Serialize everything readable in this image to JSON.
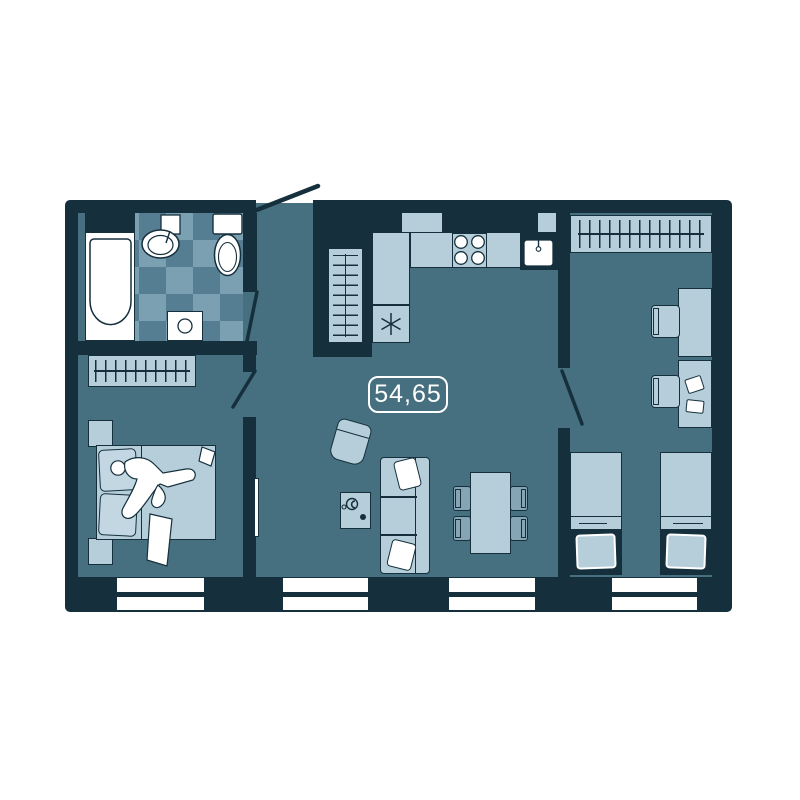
{
  "floor_plan": {
    "area_label": "54,65"
  },
  "colors": {
    "wall": "#15303c",
    "floor": "#46707f",
    "furn": "#b6ceda",
    "furn_mid": "#86a5b4",
    "pillow": "#c3d7e2",
    "tile_light": "#7aa0b2",
    "tile_dark": "#567e92",
    "label": "#ffffff"
  }
}
